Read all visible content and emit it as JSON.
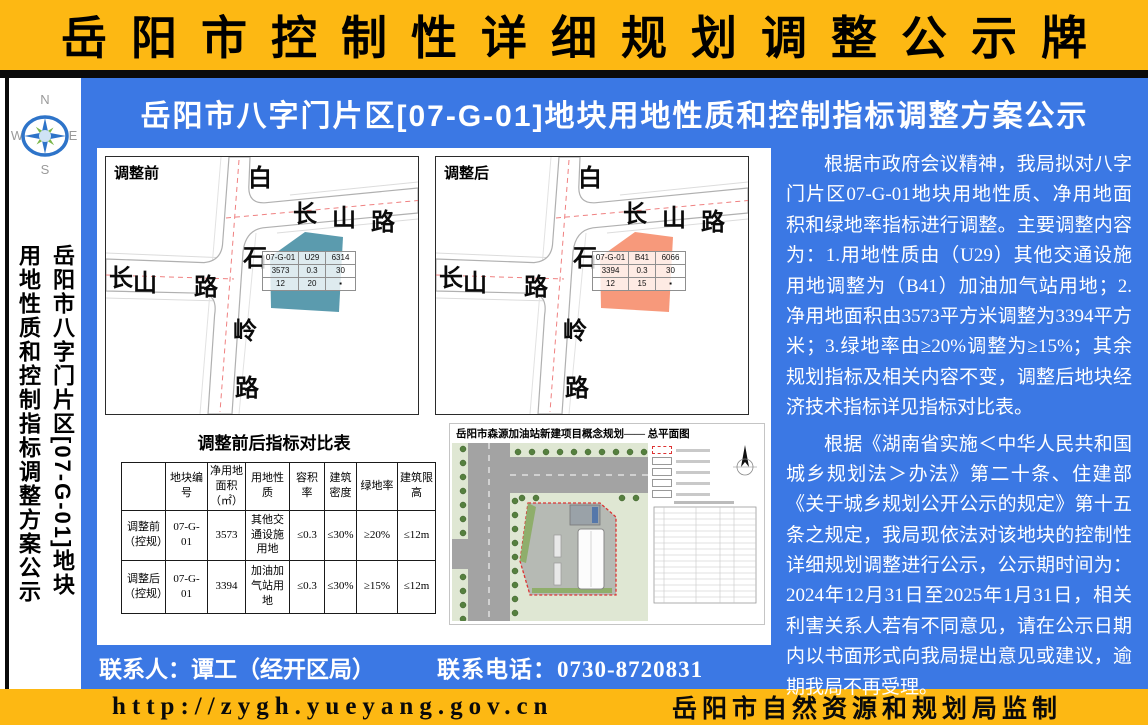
{
  "header": {
    "title": "岳阳市控制性详细规划调整公示牌"
  },
  "subtitle": "岳阳市八字门片区[07-G-01]地块用地性质和控制指标调整方案公示",
  "sidebar": {
    "compass": {
      "n": "N",
      "e": "E",
      "s": "S",
      "w": "W"
    },
    "vertical_title_line1": "岳阳市八字门片区[07-G-01]地块",
    "vertical_title_line2": "用地性质和控制指标调整方案公示"
  },
  "maps": {
    "road_labels": {
      "vertical": [
        "白",
        "石",
        "岭",
        "路"
      ],
      "right": [
        "长",
        "山",
        "路"
      ],
      "left": [
        "长",
        "山",
        "路"
      ]
    },
    "before": {
      "title": "调整前",
      "parcel_color": "#4d92a7",
      "info_table": [
        [
          "07-G-01",
          "U29",
          "6314"
        ],
        [
          "3573",
          "0.3",
          "30"
        ],
        [
          "12",
          "20",
          "▪"
        ]
      ]
    },
    "after": {
      "title": "调整后",
      "parcel_color": "#f69070",
      "info_table": [
        [
          "07-G-01",
          "B41",
          "6066"
        ],
        [
          "3394",
          "0.3",
          "30"
        ],
        [
          "12",
          "15",
          "▪"
        ]
      ]
    }
  },
  "comparison": {
    "title": "调整前后指标对比表",
    "headers": [
      "",
      "地块编号",
      "净用地面积（㎡）",
      "用地性质",
      "容积率",
      "建筑密度",
      "绿地率",
      "建筑限高"
    ],
    "rows": [
      [
        "调整前（控规）",
        "07-G-01",
        "3573",
        "其他交通设施用地",
        "≤0.3",
        "≤30%",
        "≥20%",
        "≤12m"
      ],
      [
        "调整后（控规）",
        "07-G-01",
        "3394",
        "加油加气站用地",
        "≤0.3",
        "≤30%",
        "≥15%",
        "≤12m"
      ]
    ]
  },
  "site_plan": {
    "title": "岳阳市森源加油站新建项目概念规划—— 总平面图"
  },
  "notice": {
    "paragraph1": "根据市政府会议精神，我局拟对八字门片区07-G-01地块用地性质、净用地面积和绿地率指标进行调整。主要调整内容为：1.用地性质由（U29）其他交通设施用地调整为（B41）加油加气站用地；2.净用地面积由3573平方米调整为3394平方米；3.绿地率由≥20%调整为≥15%；其余规划指标及相关内容不变，调整后地块经济技术指标详见指标对比表。",
    "paragraph2": "根据《湖南省实施＜中华人民共和国城乡规划法＞办法》第二十条、住建部《关于城乡规划公开公示的规定》第十五条之规定，我局现依法对该地块的控制性详细规划调整进行公示，公示期时间为：2024年12月31日至2025年1月31日，相关利害关系人若有不同意见，请在公示日期内以书面形式向我局提出意见或建议，逾期我局不再受理。"
  },
  "contact": {
    "person": "联系人：谭工（经开区局）",
    "phone": "联系电话：0730-8720831"
  },
  "footer": {
    "url": "http://zygh.yueyang.gov.cn",
    "publisher": "岳阳市自然资源和规划局监制"
  },
  "colors": {
    "blue": "#3b78e4",
    "yellow": "#fdb813",
    "parcel_before": "#4d92a7",
    "parcel_after": "#f69070"
  }
}
